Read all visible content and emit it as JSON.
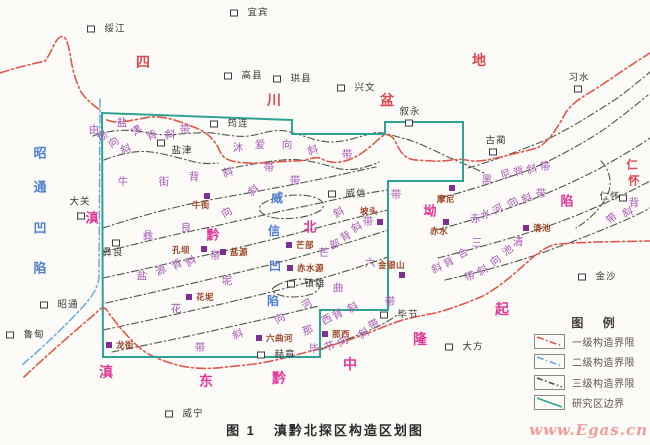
{
  "caption": {
    "fig_label": "图 1",
    "title": "滇黔北探区构造区划图"
  },
  "watermark": "www.Egas.cn",
  "colors": {
    "boundary_teal": "#2fa393",
    "level1_red": "#e2574a",
    "level2_blue": "#66aae0",
    "level3_olive": "#4c5548",
    "region_red": "#dc4850",
    "region_magenta": "#e0399a",
    "region_blue": "#4f7fd0",
    "band_purple": "#a757b5",
    "town_brown": "#9c4427",
    "city_black": "#3a3a3a",
    "marker_purple": "#7d2f92",
    "watermark_pink": "#f29b9b"
  },
  "legend": {
    "title": "图 例",
    "items": [
      {
        "label": "一级构造界限",
        "style": "level1"
      },
      {
        "label": "二级构造界限",
        "style": "level2"
      },
      {
        "label": "三级构造界限",
        "style": "level3"
      },
      {
        "label": "研究区边界",
        "style": "boundary"
      }
    ]
  },
  "map": {
    "cities": [
      {
        "name": "绥江",
        "sx": 91,
        "sy": 29,
        "tx": 101,
        "ty": 29
      },
      {
        "name": "宜宾",
        "sx": 234,
        "sy": 13,
        "tx": 244,
        "ty": 13
      },
      {
        "name": "高县",
        "sx": 228,
        "sy": 76,
        "tx": 238,
        "ty": 76
      },
      {
        "name": "珙县",
        "sx": 277,
        "sy": 79,
        "tx": 287,
        "ty": 79
      },
      {
        "name": "兴文",
        "sx": 341,
        "sy": 88,
        "tx": 351,
        "ty": 88
      },
      {
        "name": "叙永",
        "sx": 409,
        "sy": 123,
        "tx": 396,
        "ty": 112
      },
      {
        "name": "习水",
        "sx": 578,
        "sy": 89,
        "tx": 565,
        "ty": 78
      },
      {
        "name": "古蔺",
        "sx": 493,
        "sy": 152,
        "tx": 482,
        "ty": 141
      },
      {
        "name": "筠连",
        "sx": 214,
        "sy": 124,
        "tx": 224,
        "ty": 124
      },
      {
        "name": "盐津",
        "sx": 161,
        "sy": 143,
        "tx": 168,
        "ty": 151
      },
      {
        "name": "大关",
        "sx": 81,
        "sy": 216,
        "tx": 66,
        "ty": 202
      },
      {
        "name": "彝良",
        "sx": 116,
        "sy": 243,
        "tx": 99,
        "ty": 253
      },
      {
        "name": "威信",
        "sx": 332,
        "sy": 194,
        "tx": 342,
        "ty": 194
      },
      {
        "name": "仁怀",
        "sx": 623,
        "sy": 198,
        "tx": 596,
        "ty": 197
      },
      {
        "name": "镇雄",
        "sx": 291,
        "sy": 284,
        "tx": 301,
        "ty": 284
      },
      {
        "name": "昭通",
        "sx": 44,
        "sy": 305,
        "tx": 54,
        "ty": 305
      },
      {
        "name": "鲁甸",
        "sx": 10,
        "sy": 335,
        "tx": 20,
        "ty": 335
      },
      {
        "name": "威宁",
        "sx": 169,
        "sy": 414,
        "tx": 179,
        "ty": 414
      },
      {
        "name": "赫章",
        "sx": 261,
        "sy": 355,
        "tx": 271,
        "ty": 355
      },
      {
        "name": "毕节",
        "sx": 384,
        "sy": 315,
        "tx": 394,
        "ty": 315
      },
      {
        "name": "大方",
        "sx": 449,
        "sy": 347,
        "tx": 459,
        "ty": 347
      },
      {
        "name": "金沙",
        "sx": 582,
        "sy": 277,
        "tx": 592,
        "ty": 277
      }
    ],
    "towns": [
      {
        "name": "牛街",
        "sx": 207,
        "sy": 196,
        "tx": 192,
        "ty": 205
      },
      {
        "name": "孔坝",
        "sx": 204,
        "sy": 249,
        "tx": 172,
        "ty": 250
      },
      {
        "name": "盐源",
        "sx": 223,
        "sy": 252,
        "tx": 230,
        "ty": 252
      },
      {
        "name": "芒部",
        "sx": 289,
        "sy": 245,
        "tx": 296,
        "ty": 245
      },
      {
        "name": "赤水源",
        "sx": 290,
        "sy": 268,
        "tx": 297,
        "ty": 268
      },
      {
        "name": "坡头",
        "sx": 380,
        "sy": 222,
        "tx": 360,
        "ty": 211
      },
      {
        "name": "摩尼",
        "sx": 452,
        "sy": 188,
        "tx": 437,
        "ty": 199
      },
      {
        "name": "赤水",
        "sx": 446,
        "sy": 222,
        "tx": 430,
        "ty": 231
      },
      {
        "name": "金银山",
        "sx": 402,
        "sy": 275,
        "tx": 378,
        "ty": 265
      },
      {
        "name": "清池",
        "sx": 526,
        "sy": 228,
        "tx": 533,
        "ty": 228
      },
      {
        "name": "花坭",
        "sx": 189,
        "sy": 297,
        "tx": 196,
        "ty": 297
      },
      {
        "name": "龙街",
        "sx": 109,
        "sy": 345,
        "tx": 116,
        "ty": 345
      },
      {
        "name": "六曲河",
        "sx": 259,
        "sy": 338,
        "tx": 266,
        "ty": 338
      },
      {
        "name": "那西",
        "sx": 325,
        "sy": 334,
        "tx": 332,
        "ty": 334
      }
    ],
    "regions": [
      {
        "name": "四川盆地",
        "color": "#dc4850",
        "size": 14,
        "chars": [
          {
            "ch": "四",
            "x": 143,
            "y": 62
          },
          {
            "ch": "川",
            "x": 274,
            "y": 100
          },
          {
            "ch": "盆",
            "x": 387,
            "y": 100
          },
          {
            "ch": "地",
            "x": 479,
            "y": 60
          }
        ]
      },
      {
        "name": "仁怀(斜坡)",
        "color": "#dc4850",
        "size": 11.5,
        "chars": [
          {
            "ch": "仁",
            "x": 632,
            "y": 166
          },
          {
            "ch": "怀",
            "x": 634,
            "y": 182
          }
        ]
      },
      {
        "name": "昭通凹陷",
        "color": "#4f7fd0",
        "size": 13,
        "chars": [
          {
            "ch": "昭",
            "x": 40,
            "y": 153
          },
          {
            "ch": "通",
            "x": 40,
            "y": 187
          },
          {
            "ch": "凹",
            "x": 40,
            "y": 228
          },
          {
            "ch": "陷",
            "x": 40,
            "y": 268
          }
        ]
      },
      {
        "name": "威信凹陷",
        "color": "#4f7fd0",
        "size": 12,
        "chars": [
          {
            "ch": "威",
            "x": 277,
            "y": 198
          },
          {
            "ch": "信",
            "x": 274,
            "y": 231
          },
          {
            "ch": "凹",
            "x": 275,
            "y": 266
          },
          {
            "ch": "陷",
            "x": 273,
            "y": 301
          }
        ]
      },
      {
        "name": "滇黔北坳陷",
        "color": "#e0399a",
        "size": 13,
        "chars": [
          {
            "ch": "滇",
            "x": 92,
            "y": 218
          },
          {
            "ch": "黔",
            "x": 213,
            "y": 235
          },
          {
            "ch": "北",
            "x": 310,
            "y": 227
          },
          {
            "ch": "坳",
            "x": 430,
            "y": 211
          },
          {
            "ch": "陷",
            "x": 567,
            "y": 201
          }
        ]
      },
      {
        "name": "滇东",
        "color": "#e0399a",
        "size": 14,
        "chars": [
          {
            "ch": "滇",
            "x": 106,
            "y": 372
          },
          {
            "ch": "东",
            "x": 206,
            "y": 381
          }
        ]
      },
      {
        "name": "黔中",
        "color": "#e0399a",
        "size": 14,
        "chars": [
          {
            "ch": "黔",
            "x": 279,
            "y": 378
          },
          {
            "ch": "中",
            "x": 350,
            "y": 364
          }
        ]
      },
      {
        "name": "隆起",
        "color": "#e0399a",
        "size": 14,
        "chars": [
          {
            "ch": "隆",
            "x": 420,
            "y": 339
          },
          {
            "ch": "起",
            "x": 502,
            "y": 309
          }
        ]
      }
    ],
    "bands": [
      {
        "name": "盐津背斜带",
        "chars": [
          {
            "ch": "盐",
            "x": 122,
            "y": 123,
            "r": 0
          },
          {
            "ch": "津",
            "x": 137,
            "y": 131,
            "r": -40
          },
          {
            "ch": "背",
            "x": 152,
            "y": 136,
            "r": -25
          },
          {
            "ch": "斜",
            "x": 170,
            "y": 135,
            "r": 0
          },
          {
            "ch": "带",
            "x": 185,
            "y": 130,
            "r": 0
          }
        ]
      },
      {
        "name": "由坝向斜",
        "chars": [
          {
            "ch": "由",
            "x": 94,
            "y": 130,
            "r": 0
          },
          {
            "ch": "坝",
            "x": 103,
            "y": 137,
            "r": -35
          },
          {
            "ch": "向",
            "x": 114,
            "y": 143,
            "r": -35
          },
          {
            "ch": "斜",
            "x": 126,
            "y": 150,
            "r": -20
          }
        ]
      },
      {
        "name": "沐爱向斜带",
        "chars": [
          {
            "ch": "沐",
            "x": 238,
            "y": 148,
            "r": 0
          },
          {
            "ch": "爱",
            "x": 260,
            "y": 145,
            "r": 0
          },
          {
            "ch": "向",
            "x": 287,
            "y": 145,
            "r": 0
          },
          {
            "ch": "斜",
            "x": 313,
            "y": 151,
            "r": -15
          },
          {
            "ch": "带",
            "x": 347,
            "y": 155,
            "r": 0
          }
        ]
      },
      {
        "name": "牛街背斜带",
        "chars": [
          {
            "ch": "牛",
            "x": 123,
            "y": 182,
            "r": 0
          },
          {
            "ch": "街",
            "x": 164,
            "y": 182,
            "r": 0
          },
          {
            "ch": "背",
            "x": 194,
            "y": 177,
            "r": 0
          },
          {
            "ch": "斜",
            "x": 228,
            "y": 173,
            "r": -15
          },
          {
            "ch": "带",
            "x": 269,
            "y": 168,
            "r": 0
          }
        ]
      },
      {
        "name": "彝良向斜带",
        "chars": [
          {
            "ch": "彝",
            "x": 148,
            "y": 236,
            "r": 0
          },
          {
            "ch": "良",
            "x": 186,
            "y": 228,
            "r": 0
          },
          {
            "ch": "向",
            "x": 227,
            "y": 213,
            "r": -30
          },
          {
            "ch": "斜",
            "x": 254,
            "y": 191,
            "r": -35
          },
          {
            "ch": "带",
            "x": 295,
            "y": 181,
            "r": 0
          }
        ]
      },
      {
        "name": "盐源背斜带",
        "chars": [
          {
            "ch": "盐",
            "x": 142,
            "y": 276,
            "r": 0
          },
          {
            "ch": "源",
            "x": 161,
            "y": 271,
            "r": -25
          },
          {
            "ch": "背",
            "x": 177,
            "y": 265,
            "r": -30
          },
          {
            "ch": "斜",
            "x": 191,
            "y": 262,
            "r": -30
          },
          {
            "ch": "带",
            "x": 215,
            "y": 256,
            "r": 0
          }
        ]
      },
      {
        "name": "芒部背斜带",
        "chars": [
          {
            "ch": "芒",
            "x": 324,
            "y": 253,
            "r": 0
          },
          {
            "ch": "部",
            "x": 335,
            "y": 245,
            "r": -20
          },
          {
            "ch": "背",
            "x": 346,
            "y": 237,
            "r": -30
          },
          {
            "ch": "斜",
            "x": 357,
            "y": 228,
            "r": -30
          },
          {
            "ch": "带",
            "x": 368,
            "y": 222,
            "r": 0
          }
        ]
      },
      {
        "name": "坡头向斜带",
        "chars": [
          {
            "ch": "斜",
            "x": 339,
            "y": 213,
            "r": -30
          },
          {
            "ch": "带",
            "x": 396,
            "y": 195,
            "r": 0
          }
        ]
      },
      {
        "name": "六曲河向斜带",
        "chars": [
          {
            "ch": "六",
            "x": 370,
            "y": 263,
            "r": 0
          },
          {
            "ch": "曲",
            "x": 338,
            "y": 288,
            "r": 0
          },
          {
            "ch": "河",
            "x": 307,
            "y": 305,
            "r": -30
          },
          {
            "ch": "向",
            "x": 280,
            "y": 319,
            "r": -30
          },
          {
            "ch": "斜",
            "x": 238,
            "y": 335,
            "r": -20
          },
          {
            "ch": "带",
            "x": 200,
            "y": 348,
            "r": 0
          }
        ]
      },
      {
        "name": "花坭背斜",
        "chars": [
          {
            "ch": "坭",
            "x": 227,
            "y": 281,
            "r": 0
          },
          {
            "ch": "花",
            "x": 176,
            "y": 309,
            "r": 0
          }
        ]
      },
      {
        "name": "那西背斜带",
        "chars": [
          {
            "ch": "那",
            "x": 308,
            "y": 331,
            "r": -20
          },
          {
            "ch": "西",
            "x": 327,
            "y": 320,
            "r": -30
          },
          {
            "ch": "背",
            "x": 338,
            "y": 315,
            "r": -30
          },
          {
            "ch": "斜",
            "x": 353,
            "y": 308,
            "r": -30
          },
          {
            "ch": "带",
            "x": 390,
            "y": 302,
            "r": 0
          }
        ]
      },
      {
        "name": "毕节向斜带",
        "chars": [
          {
            "ch": "毕",
            "x": 314,
            "y": 349,
            "r": 0
          },
          {
            "ch": "节",
            "x": 330,
            "y": 347,
            "r": -20
          },
          {
            "ch": "向",
            "x": 343,
            "y": 342,
            "r": -30
          },
          {
            "ch": "斜",
            "x": 364,
            "y": 334,
            "r": -30
          },
          {
            "ch": "带",
            "x": 374,
            "y": 325,
            "r": -30
          }
        ]
      },
      {
        "name": "黑尼背斜带",
        "chars": [
          {
            "ch": "黑",
            "x": 487,
            "y": 180,
            "r": 0
          },
          {
            "ch": "尼",
            "x": 506,
            "y": 175,
            "r": -20
          },
          {
            "ch": "背",
            "x": 519,
            "y": 172,
            "r": -20
          },
          {
            "ch": "斜",
            "x": 532,
            "y": 170,
            "r": -15
          },
          {
            "ch": "带",
            "x": 545,
            "y": 167,
            "r": 0
          }
        ]
      },
      {
        "name": "赤水河向斜带",
        "chars": [
          {
            "ch": "赤",
            "x": 475,
            "y": 219,
            "r": 0
          },
          {
            "ch": "水",
            "x": 486,
            "y": 215,
            "r": -25
          },
          {
            "ch": "河",
            "x": 498,
            "y": 210,
            "r": -30
          },
          {
            "ch": "向",
            "x": 513,
            "y": 203,
            "r": -30
          },
          {
            "ch": "斜",
            "x": 527,
            "y": 199,
            "r": -20
          },
          {
            "ch": "带",
            "x": 541,
            "y": 194,
            "r": 0
          }
        ]
      },
      {
        "name": "仁怀背斜带",
        "chars": [
          {
            "ch": "背",
            "x": 634,
            "y": 203,
            "r": 0
          },
          {
            "ch": "斜",
            "x": 628,
            "y": 213,
            "r": -20
          },
          {
            "ch": "带",
            "x": 612,
            "y": 219,
            "r": -40
          }
        ]
      },
      {
        "name": "清池向斜带",
        "chars": [
          {
            "ch": "清",
            "x": 518,
            "y": 242,
            "r": 0
          },
          {
            "ch": "池",
            "x": 508,
            "y": 251,
            "r": -40
          },
          {
            "ch": "向",
            "x": 496,
            "y": 261,
            "r": -40
          },
          {
            "ch": "斜",
            "x": 483,
            "y": 271,
            "r": -30
          },
          {
            "ch": "带",
            "x": 470,
            "y": 277,
            "r": -20
          }
        ]
      },
      {
        "name": "三合背斜",
        "chars": [
          {
            "ch": "三",
            "x": 477,
            "y": 243,
            "r": 0
          },
          {
            "ch": "合",
            "x": 463,
            "y": 254,
            "r": -30
          },
          {
            "ch": "背",
            "x": 449,
            "y": 263,
            "r": -30
          },
          {
            "ch": "斜",
            "x": 437,
            "y": 269,
            "r": -20
          }
        ]
      }
    ]
  }
}
